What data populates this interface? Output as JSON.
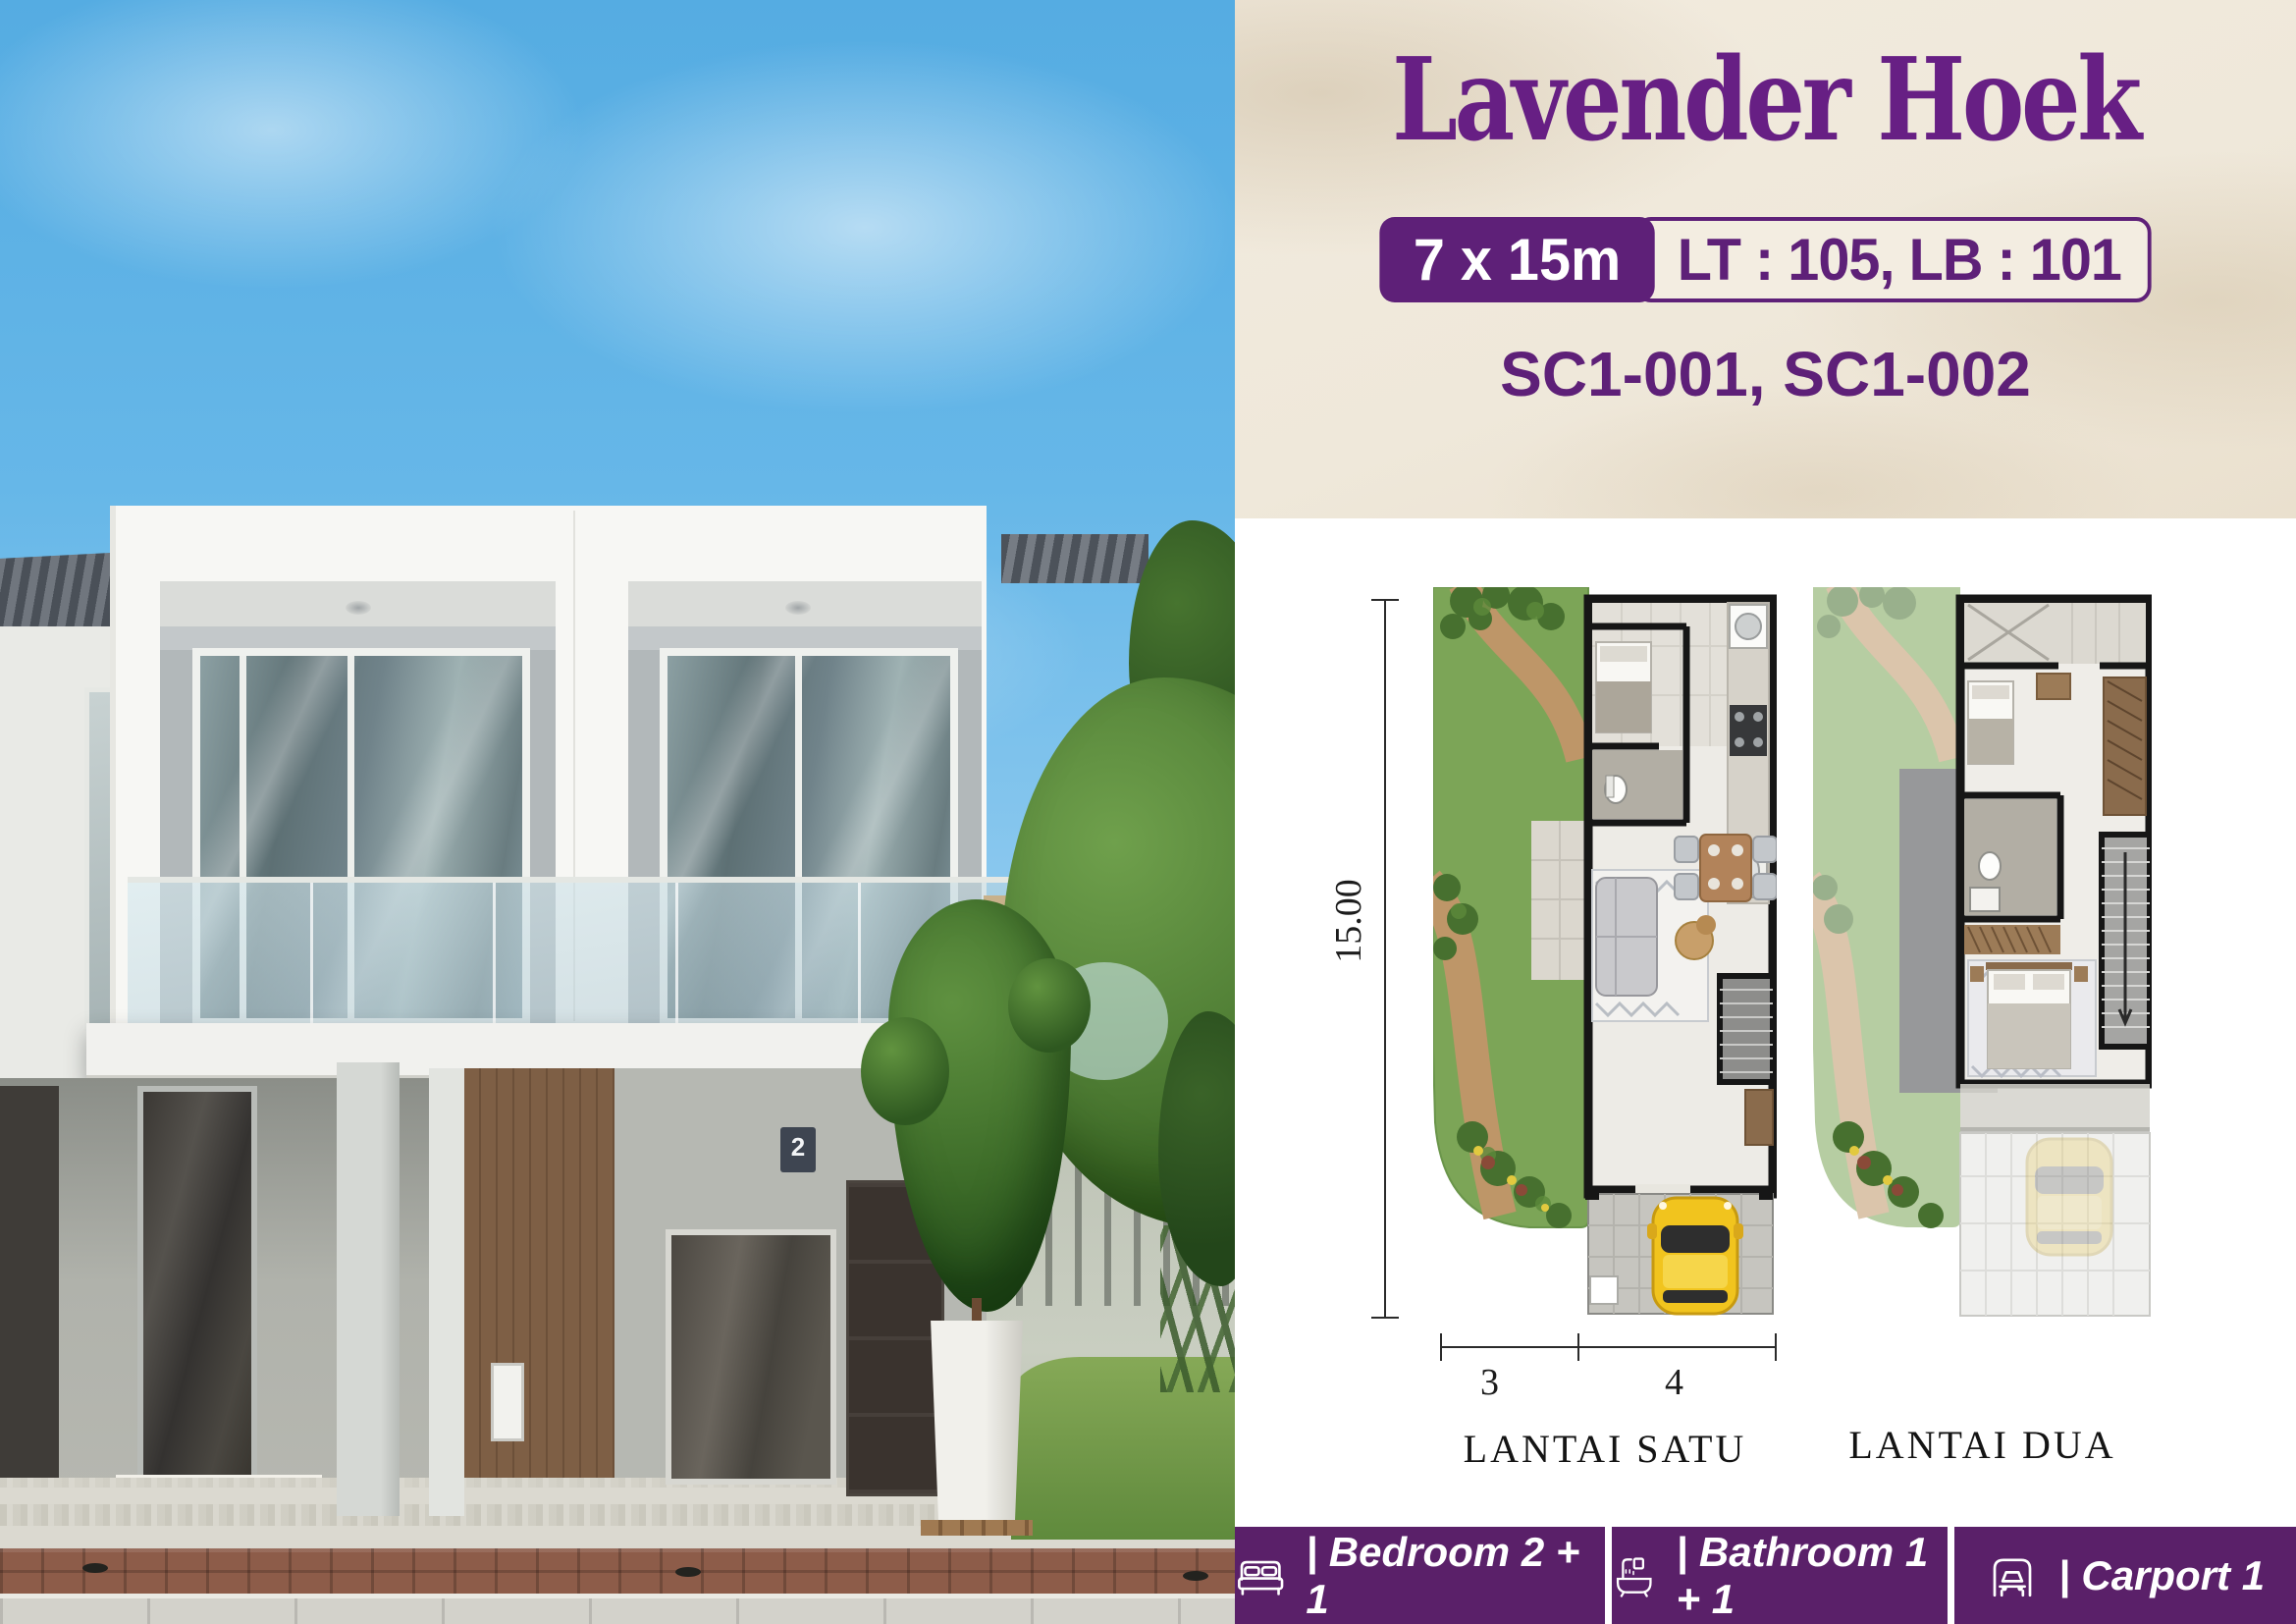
{
  "header": {
    "title": "Lavender Hoek",
    "size_badge": "7 x 15m",
    "area_badge": "LT : 105, LB : 101",
    "unit_codes": "SC1-001, SC1-002"
  },
  "plans": {
    "floor1_label": "LANTAI SATU",
    "floor2_label": "LANTAI DUA",
    "dim_vertical": "15.00",
    "dim_width_left": "3",
    "dim_width_right": "4"
  },
  "features": [
    {
      "icon": "bed-icon",
      "label": "| Bedroom 2 + 1"
    },
    {
      "icon": "bath-icon",
      "label": "| Bathroom 1 + 1"
    },
    {
      "icon": "car-icon",
      "label": "| Carport 1"
    }
  ],
  "photo": {
    "house_number": "2"
  },
  "colors": {
    "title_purple": "#671F84",
    "badge_purple": "#5E2078",
    "bar_purple": "#5A2069",
    "cream": "#EFE8DB"
  }
}
